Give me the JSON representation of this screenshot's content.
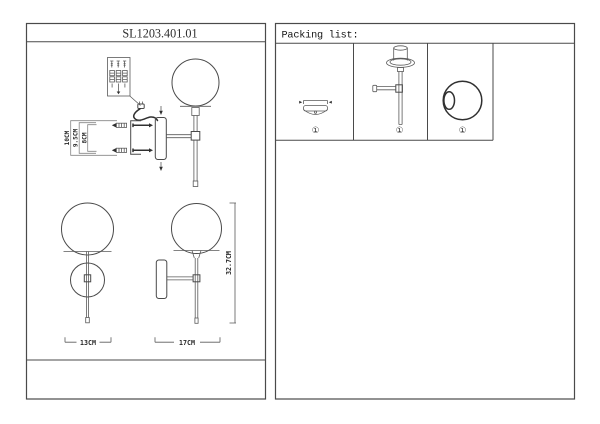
{
  "left_panel": {
    "title": "SL1203.401.01",
    "exploded_view": {
      "dims": {
        "bracket_height": "10CM",
        "plate_height": "9.5CM",
        "screw_span": "8CM"
      }
    },
    "front_view": {
      "width_label": "13CM"
    },
    "side_view": {
      "width_label": "17CM",
      "height_label": "32.7CM"
    }
  },
  "packing_list": {
    "header": "Packing list:",
    "items": [
      {
        "name": "wall canopy",
        "qty_label": "①"
      },
      {
        "name": "lamp body with arm",
        "qty_label": "①"
      },
      {
        "name": "glass globe",
        "qty_label": "①"
      }
    ]
  },
  "colors": {
    "background": "#ffffff",
    "line": "#4a4a4a",
    "line_dark": "#303030",
    "line_light": "#858585"
  }
}
